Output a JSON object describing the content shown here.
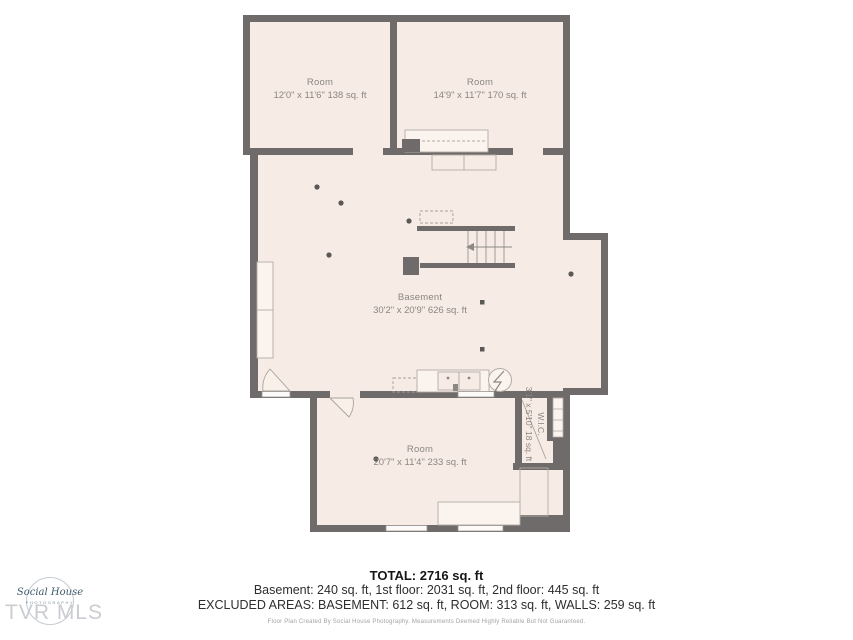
{
  "floorplan": {
    "rooms": [
      {
        "label": "Room",
        "dims": "12'0\" x 11'6\" 138 sq. ft"
      },
      {
        "label": "Room",
        "dims": "14'9\" x 11'7\" 170 sq. ft"
      },
      {
        "label": "Basement",
        "dims": "30'2\" x 20'9\" 626 sq. ft"
      },
      {
        "label": "Room",
        "dims": "20'7\" x 11'4\" 233 sq. ft"
      },
      {
        "label": "W.I.C.",
        "dims": "3'1\" x 5'10\" 18 sq. ft"
      }
    ]
  },
  "summary": {
    "total": "TOTAL: 2716 sq. ft",
    "floors": "Basement: 240 sq. ft, 1st floor: 2031 sq. ft, 2nd floor: 445 sq. ft",
    "excluded": "EXCLUDED AREAS: BASEMENT: 612 sq. ft, ROOM: 313 sq. ft, WALLS: 259 sq. ft",
    "disclaimer": "Floor Plan Created By Social House Photography. Measurements Deemed Highly Reliable But Not Guaranteed."
  },
  "branding": {
    "logo_script": "Social House",
    "logo_sub": "PHOTOGRAPHY",
    "watermark": "TVR MLS"
  },
  "colors": {
    "wall": "#6f6b6a",
    "floor": "#f7ece5",
    "label": "#8a8580"
  }
}
